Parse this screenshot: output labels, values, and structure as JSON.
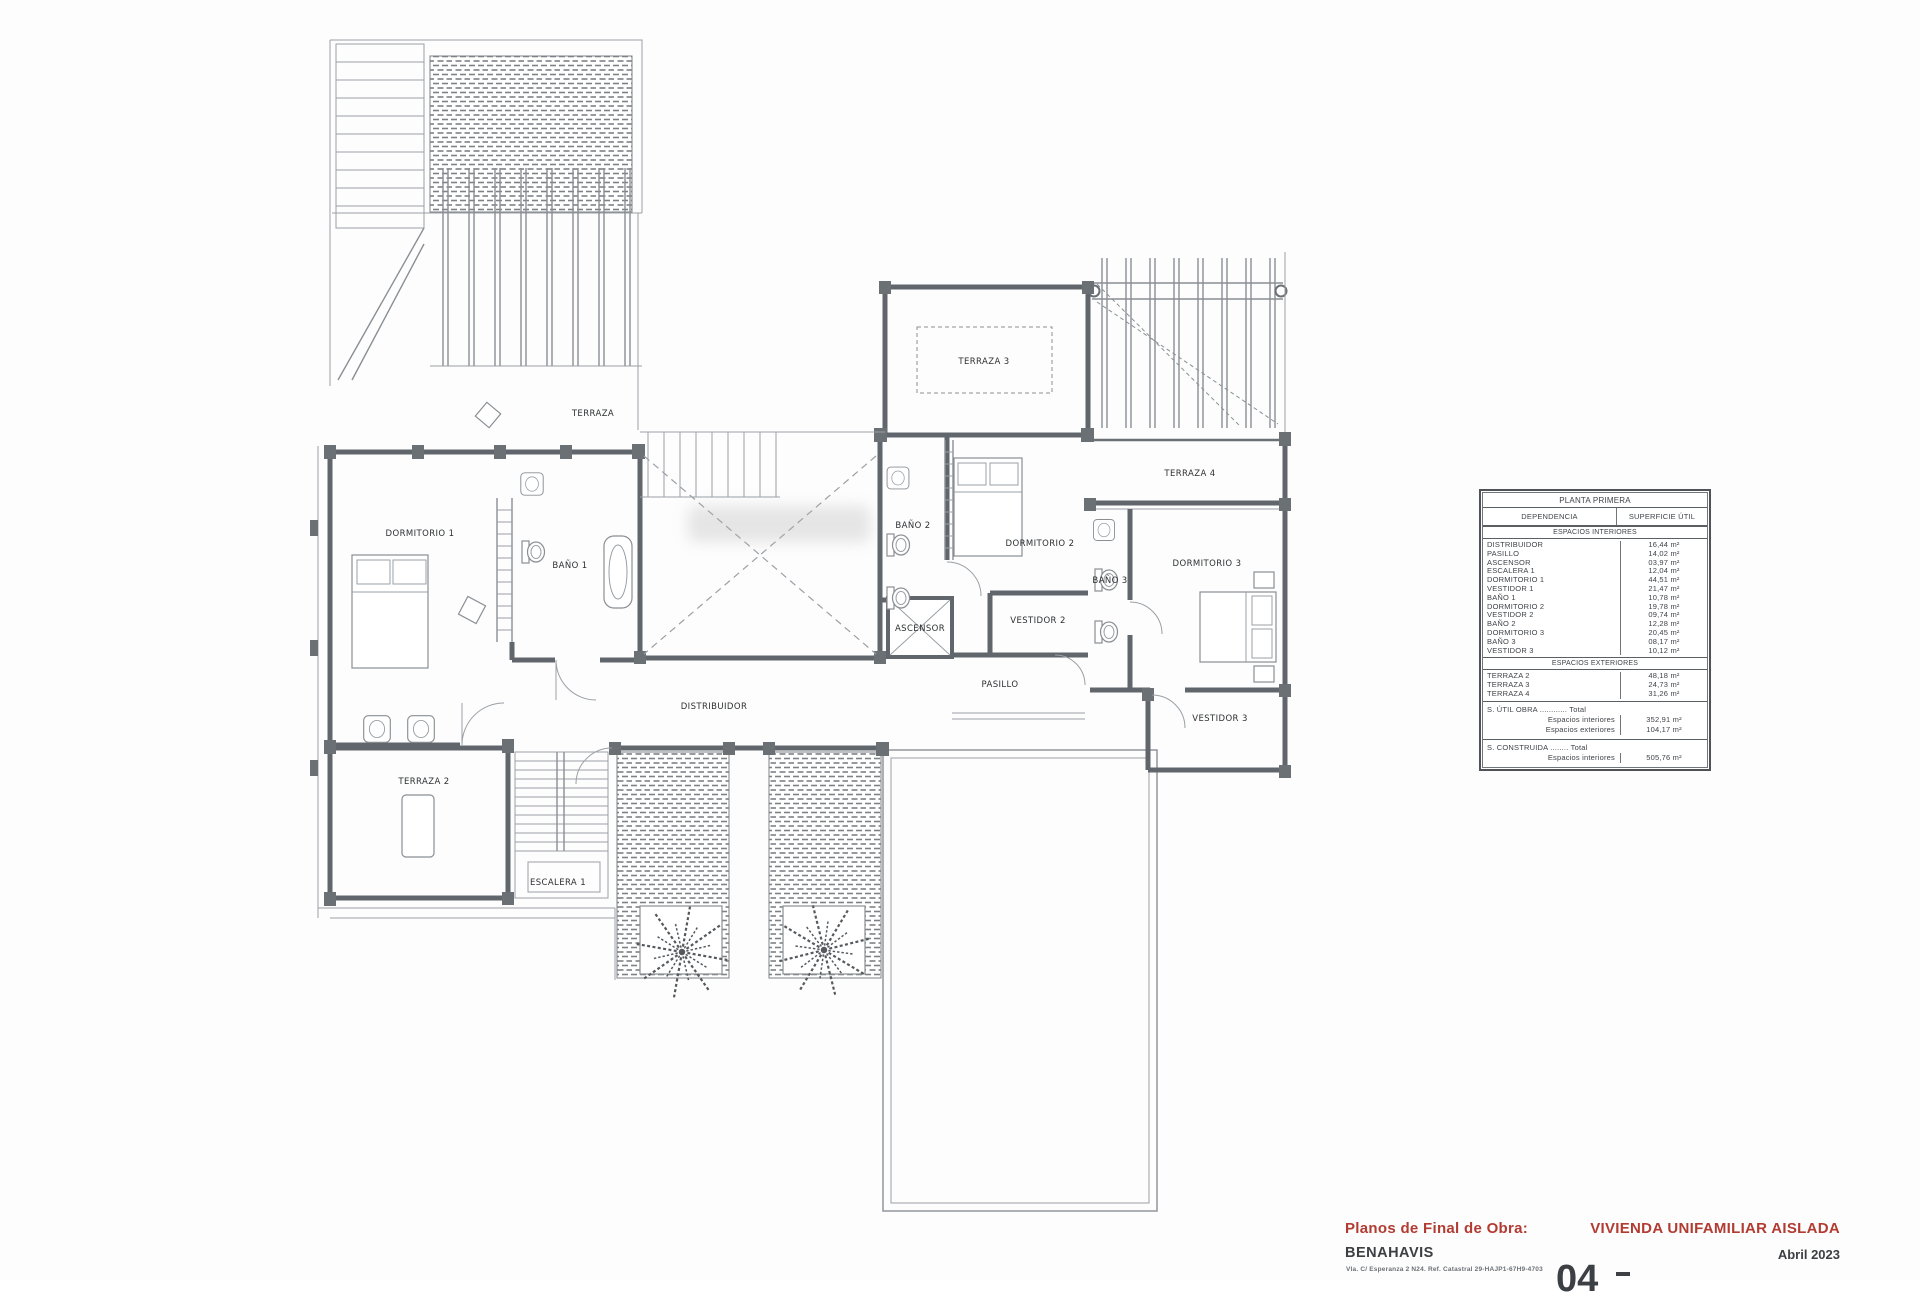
{
  "title_block": {
    "doc_type": "Planos de Final de Obra:",
    "project": "VIVIENDA UNIFAMILIAR AISLADA",
    "location": "BENAHAVIS",
    "date": "Abril 2023",
    "address_line": "Vla. C/ Esperanza 2 N24. Ref. Catastral 29-HAJP1-67H9-4703",
    "sheet_number": "04",
    "accent_color": "#b23b32"
  },
  "area_table": {
    "title": "PLANTA PRIMERA",
    "col_dependencia": "DEPENDENCIA",
    "col_superficie": "SUPERFICIE ÚTIL",
    "section_interiores": "ESPACIOS INTERIORES",
    "interior_rows": [
      {
        "label": "DISTRIBUIDOR",
        "value": "16,44 m²"
      },
      {
        "label": "PASILLO",
        "value": "14,02 m²"
      },
      {
        "label": "ASCENSOR",
        "value": "03,97 m²"
      },
      {
        "label": "ESCALERA 1",
        "value": "12,04 m²"
      },
      {
        "label": "DORMITORIO 1",
        "value": "44,51 m²"
      },
      {
        "label": "VESTIDOR 1",
        "value": "21,47 m²"
      },
      {
        "label": "BAÑO 1",
        "value": "10,78 m²"
      },
      {
        "label": "DORMITORIO 2",
        "value": "19,78 m²"
      },
      {
        "label": "VESTIDOR 2",
        "value": "09,74 m²"
      },
      {
        "label": "BAÑO 2",
        "value": "12,28 m²"
      },
      {
        "label": "DORMITORIO 3",
        "value": "20,45 m²"
      },
      {
        "label": "BAÑO 3",
        "value": "08,17 m²"
      },
      {
        "label": "VESTIDOR 3",
        "value": "10,12 m²"
      }
    ],
    "section_exteriores": "ESPACIOS EXTERIORES",
    "exterior_rows": [
      {
        "label": "TERRAZA 2",
        "value": "48,18 m²"
      },
      {
        "label": "TERRAZA 3",
        "value": "24,73 m²"
      },
      {
        "label": "TERRAZA 4",
        "value": "31,26 m²"
      }
    ],
    "totals_util": {
      "heading": "S. ÚTIL OBRA ............ Total",
      "lines": [
        {
          "label": "Espacios interiores",
          "value": "352,91 m²"
        },
        {
          "label": "Espacios exteriores",
          "value": "104,17 m²"
        }
      ]
    },
    "totals_construida": {
      "heading": "S. CONSTRUIDA ........ Total",
      "lines": [
        {
          "label": "Espacios interiores",
          "value": "505,76 m²"
        }
      ]
    }
  },
  "plan": {
    "labels": [
      {
        "id": "terraza",
        "text": "TERRAZA",
        "x": 593,
        "y": 416,
        "size": 8
      },
      {
        "id": "terraza-3",
        "text": "TERRAZA 3",
        "x": 984,
        "y": 364,
        "size": 7
      },
      {
        "id": "terraza-4",
        "text": "TERRAZA 4",
        "x": 1190,
        "y": 476,
        "size": 7.5
      },
      {
        "id": "dormitorio-1",
        "text": "DORMITORIO 1",
        "x": 420,
        "y": 536,
        "size": 8.5
      },
      {
        "id": "bano-1",
        "text": "BAÑO 1",
        "x": 570,
        "y": 568,
        "size": 7
      },
      {
        "id": "dormitorio-2",
        "text": "DORMITORIO 2",
        "x": 1040,
        "y": 546,
        "size": 7.5
      },
      {
        "id": "bano-2",
        "text": "BAÑO 2",
        "x": 913,
        "y": 528,
        "size": 6.5
      },
      {
        "id": "ascensor",
        "text": "ASCENSOR",
        "x": 920,
        "y": 631,
        "size": 5
      },
      {
        "id": "vestidor-2",
        "text": "VESTIDOR 2",
        "x": 1038,
        "y": 623,
        "size": 6.5
      },
      {
        "id": "pasillo",
        "text": "PASILLO",
        "x": 1000,
        "y": 687,
        "size": 7
      },
      {
        "id": "distribuidor",
        "text": "DISTRIBUIDOR",
        "x": 714,
        "y": 709,
        "size": 8
      },
      {
        "id": "dormitorio-3",
        "text": "DORMITORIO 3",
        "x": 1207,
        "y": 566,
        "size": 7.5
      },
      {
        "id": "bano-3",
        "text": "BAÑO 3",
        "x": 1110,
        "y": 583,
        "size": 6.5
      },
      {
        "id": "vestidor-3",
        "text": "VESTIDOR 3",
        "x": 1220,
        "y": 721,
        "size": 7
      },
      {
        "id": "terraza-2",
        "text": "TERRAZA 2",
        "x": 424,
        "y": 784,
        "size": 7.5
      },
      {
        "id": "escalera-1",
        "text": "ESCALERA 1",
        "x": 558,
        "y": 885,
        "size": 6.5
      }
    ]
  }
}
